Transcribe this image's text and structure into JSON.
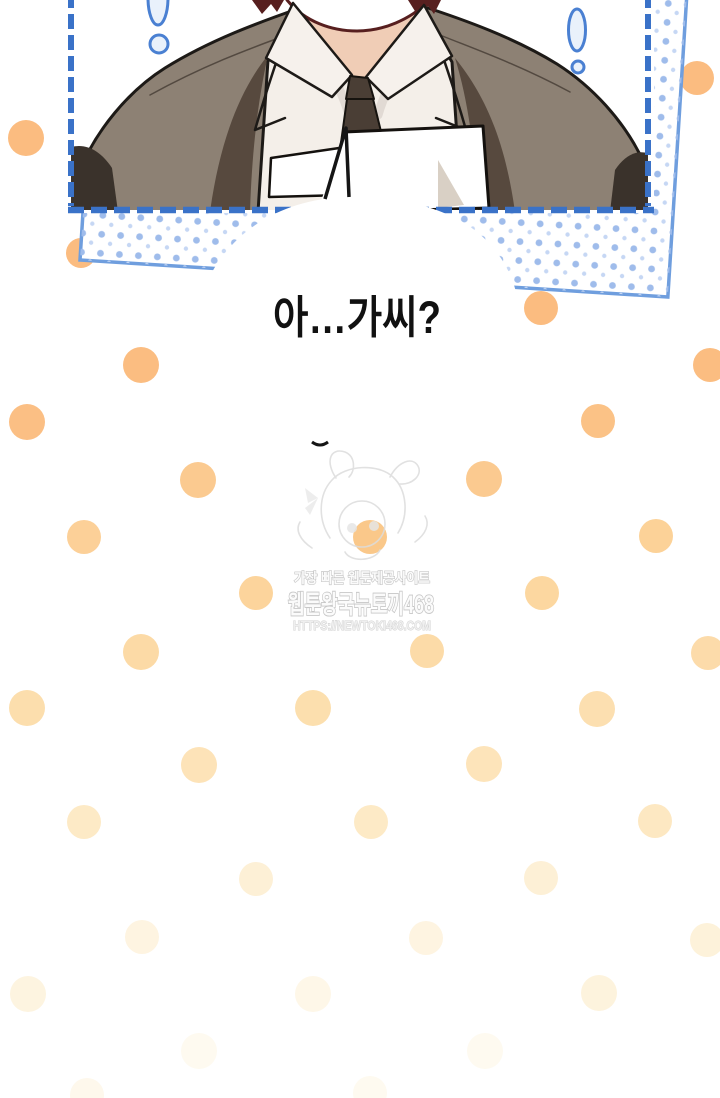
{
  "speech_bubble": {
    "text": "아…가씨?"
  },
  "watermark": {
    "line1": "가장 빠른 웹툰제공사이트",
    "line2": "웹툰왕국뉴토끼468",
    "line3": "HTTPS://NEWTOKI468.COM"
  },
  "panel": {
    "dashed_border_color": "#3a72c8",
    "outer_border_color": "#6f9ede",
    "halftone_dot_color": "#9fbceb",
    "halftone_dot_color_light": "#c6d7f4",
    "exclamation_stroke": "#4a80d2",
    "exclamation_fill": "#e9f1fb"
  },
  "art_colors": {
    "jacket": "#8d8174",
    "jacket_shadow": "#57493e",
    "jacket_dark": "#3a322b",
    "shirt": "#f4efe9",
    "shirt_shadow": "#d8d1ca",
    "collar": "#f6f1ec",
    "tie": "#4a3e35",
    "skin": "#f0cdb6",
    "jaw_outline": "#571f1f",
    "paper": "#ffffff",
    "paper_shadow": "#d9d0c5",
    "outline": "#1d1a17"
  },
  "bubble_style": {
    "fill": "#ffffff",
    "stroke": "#151515",
    "text_color": "#111111"
  },
  "watermark_style": {
    "stroke": "#c6c6c6",
    "fill": "#fbfbfb",
    "sketch": "#dcdcdc"
  },
  "polka_dots": [
    {
      "x": 697,
      "y": 78,
      "r": 17,
      "c": "#fbbc80",
      "front": false
    },
    {
      "x": 26,
      "y": 138,
      "r": 18,
      "c": "#fbbc80",
      "front": false
    },
    {
      "x": 81,
      "y": 253,
      "r": 15,
      "c": "#fbbc80",
      "front": false
    },
    {
      "x": 541,
      "y": 308,
      "r": 17,
      "c": "#fbbc80",
      "front": true
    },
    {
      "x": 141,
      "y": 365,
      "r": 18,
      "c": "#fbbd81",
      "front": false
    },
    {
      "x": 710,
      "y": 365,
      "r": 17,
      "c": "#fbbd81",
      "front": false
    },
    {
      "x": 27,
      "y": 422,
      "r": 18,
      "c": "#fbbf84",
      "front": false
    },
    {
      "x": 598,
      "y": 421,
      "r": 17,
      "c": "#fbc286",
      "front": false
    },
    {
      "x": 198,
      "y": 480,
      "r": 18,
      "c": "#fbca90",
      "front": false
    },
    {
      "x": 484,
      "y": 479,
      "r": 18,
      "c": "#fbca90",
      "front": false
    },
    {
      "x": 84,
      "y": 537,
      "r": 17,
      "c": "#fcd098",
      "front": false
    },
    {
      "x": 370,
      "y": 537,
      "r": 17,
      "c": "#fac88a",
      "front": false
    },
    {
      "x": 656,
      "y": 536,
      "r": 17,
      "c": "#fcd298",
      "front": false
    },
    {
      "x": 256,
      "y": 593,
      "r": 17,
      "c": "#fcd49c",
      "front": false
    },
    {
      "x": 542,
      "y": 593,
      "r": 17,
      "c": "#fcd7a0",
      "front": false
    },
    {
      "x": 141,
      "y": 652,
      "r": 18,
      "c": "#fcdaa6",
      "front": false
    },
    {
      "x": 427,
      "y": 651,
      "r": 17,
      "c": "#fcdba8",
      "front": false
    },
    {
      "x": 708,
      "y": 653,
      "r": 17,
      "c": "#fcdbaa",
      "front": false
    },
    {
      "x": 27,
      "y": 708,
      "r": 18,
      "c": "#fcdead",
      "front": false
    },
    {
      "x": 313,
      "y": 708,
      "r": 18,
      "c": "#fcdfae",
      "front": false
    },
    {
      "x": 597,
      "y": 709,
      "r": 18,
      "c": "#fcdfb0",
      "front": false
    },
    {
      "x": 199,
      "y": 765,
      "r": 18,
      "c": "#fde3b8",
      "front": false
    },
    {
      "x": 484,
      "y": 764,
      "r": 18,
      "c": "#fde4ba",
      "front": false
    },
    {
      "x": 84,
      "y": 822,
      "r": 17,
      "c": "#fdeac6",
      "front": false
    },
    {
      "x": 371,
      "y": 822,
      "r": 17,
      "c": "#fdeac6",
      "front": false
    },
    {
      "x": 655,
      "y": 821,
      "r": 17,
      "c": "#fde8c2",
      "front": false
    },
    {
      "x": 256,
      "y": 879,
      "r": 17,
      "c": "#fdf0d6",
      "front": false
    },
    {
      "x": 541,
      "y": 878,
      "r": 17,
      "c": "#fdf0d6",
      "front": false
    },
    {
      "x": 142,
      "y": 937,
      "r": 17,
      "c": "#fef4e1",
      "front": false
    },
    {
      "x": 426,
      "y": 938,
      "r": 17,
      "c": "#fef4e1",
      "front": false
    },
    {
      "x": 707,
      "y": 940,
      "r": 17,
      "c": "#fdf2da",
      "front": false
    },
    {
      "x": 28,
      "y": 994,
      "r": 18,
      "c": "#fdf4e0",
      "front": false
    },
    {
      "x": 313,
      "y": 994,
      "r": 18,
      "c": "#fef7e8",
      "front": false
    },
    {
      "x": 599,
      "y": 993,
      "r": 18,
      "c": "#fdf3dd",
      "front": false
    },
    {
      "x": 199,
      "y": 1051,
      "r": 18,
      "c": "#fefaf0",
      "front": false
    },
    {
      "x": 485,
      "y": 1051,
      "r": 18,
      "c": "#fefaf0",
      "front": false
    },
    {
      "x": 87,
      "y": 1095,
      "r": 17,
      "c": "#fef8ec",
      "front": false
    },
    {
      "x": 370,
      "y": 1093,
      "r": 17,
      "c": "#fefaf0",
      "front": false
    }
  ]
}
